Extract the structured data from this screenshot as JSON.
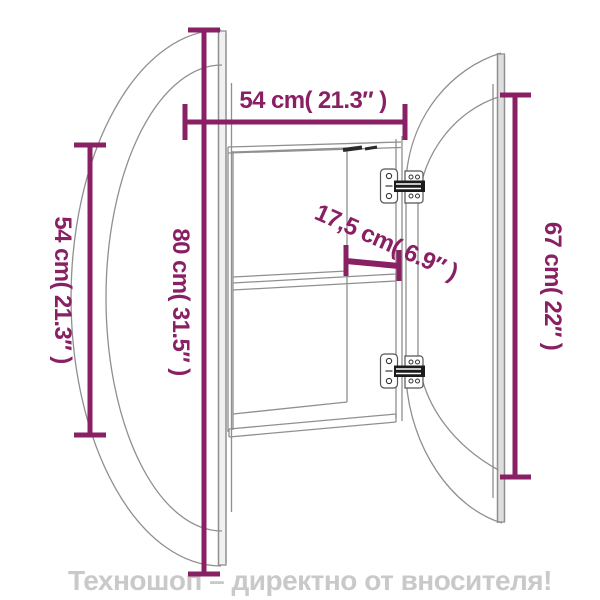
{
  "watermark": {
    "text": "Техношоп – директно от вносителя!"
  },
  "dimensions": {
    "width_top": "54 cm( 21.3″ )",
    "height_door": "80 cm( 31.5″ )",
    "height_left": "54 cm( 21.3″ )",
    "depth": "17,5 cm( 6.9″ )",
    "height_right": "67 cm( 22″ )"
  },
  "colors": {
    "dimension_lines": "#8a2064",
    "structure_lines": "#8f8f8f",
    "hinge_dark": "#1c1c1c",
    "watermark_text": "#c9c9c9",
    "background": "#ffffff"
  }
}
